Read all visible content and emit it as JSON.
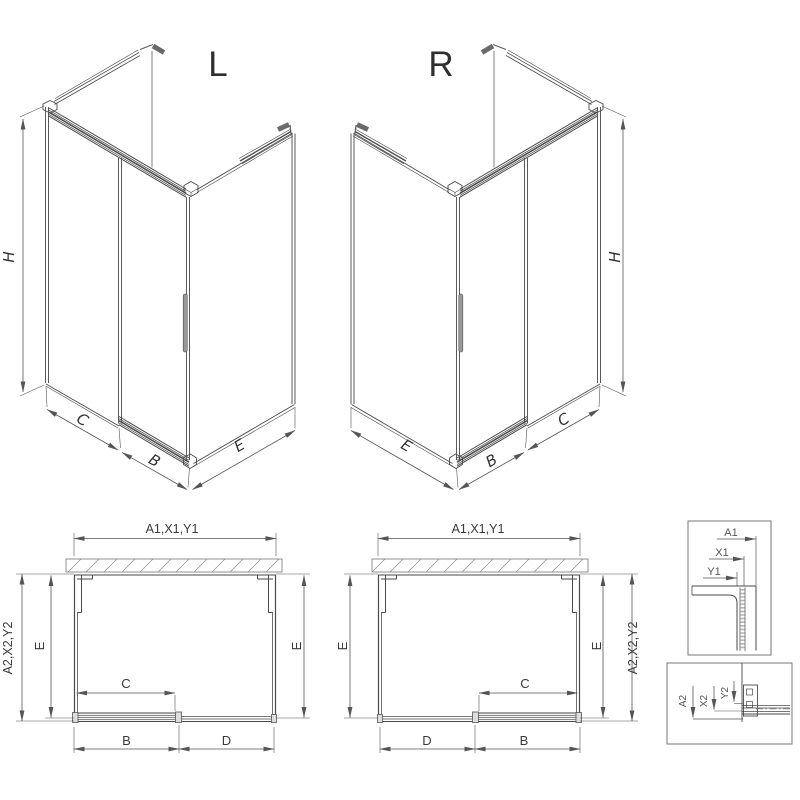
{
  "page": {
    "description": "Technical drawing of sliding-door shower enclosure, left and right variants",
    "background": "#ffffff",
    "line_color": "#4a4a4a",
    "dim_color": "#555555"
  },
  "labels": {
    "iso_left": {
      "title": "L",
      "h": "H",
      "c": "C",
      "b": "B",
      "e": "E"
    },
    "iso_right": {
      "title": "R",
      "h": "H",
      "c": "C",
      "b": "B",
      "e": "E"
    },
    "plan_left": {
      "top": "A1,X1,Y1",
      "side": "A2,X2,Y2",
      "e_left": "E",
      "e_right": "E",
      "c": "C",
      "b": "B",
      "d": "D"
    },
    "plan_right": {
      "top": "A1,X1,Y1",
      "side": "A2,X2,Y2",
      "e_left": "E",
      "e_right": "E",
      "c": "C",
      "d": "D",
      "b": "B"
    },
    "detail_top": {
      "a": "A1",
      "x": "X1",
      "y": "Y1"
    },
    "detail_bottom": {
      "a": "A2",
      "x": "X2",
      "y": "Y2"
    }
  }
}
